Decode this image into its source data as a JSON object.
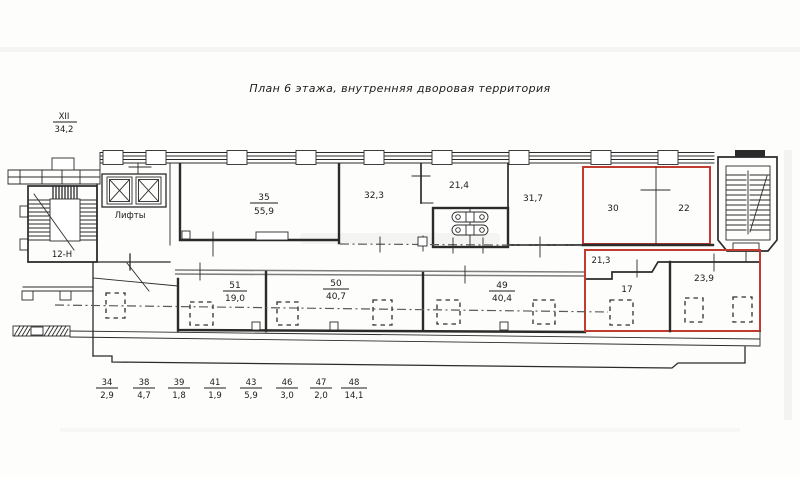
{
  "title": "План 6 этажа, внутренняя дворовая территория",
  "corner_mark": {
    "num": "XII",
    "den": "34,2"
  },
  "left_wing": {
    "stair_label": "12-Н",
    "elevators_label": "Лифты"
  },
  "rooms": {
    "r35": {
      "num": "35",
      "den": "55,9"
    },
    "r32_3": "32,3",
    "r21_4": "21,4",
    "r31_7": "31,7",
    "r30": "30",
    "r22": "22",
    "r51": {
      "num": "51",
      "den": "19,0"
    },
    "r50": {
      "num": "50",
      "den": "40,7"
    },
    "r49": {
      "num": "49",
      "den": "40,4"
    },
    "r21_3": "21,3",
    "r17": "17",
    "r23_9": "23,9"
  },
  "dimensions": [
    {
      "num": "34",
      "den": "2,9"
    },
    {
      "num": "38",
      "den": "4,7"
    },
    {
      "num": "39",
      "den": "1,8"
    },
    {
      "num": "41",
      "den": "1,9"
    },
    {
      "num": "43",
      "den": "5,9"
    },
    {
      "num": "46",
      "den": "3,0"
    },
    {
      "num": "47",
      "den": "2,0"
    },
    {
      "num": "48",
      "den": "14,1"
    }
  ],
  "colors": {
    "ink": "#2b2b2b",
    "highlight_red": "#c23b31",
    "wall_gray": "#7d7d7d"
  }
}
